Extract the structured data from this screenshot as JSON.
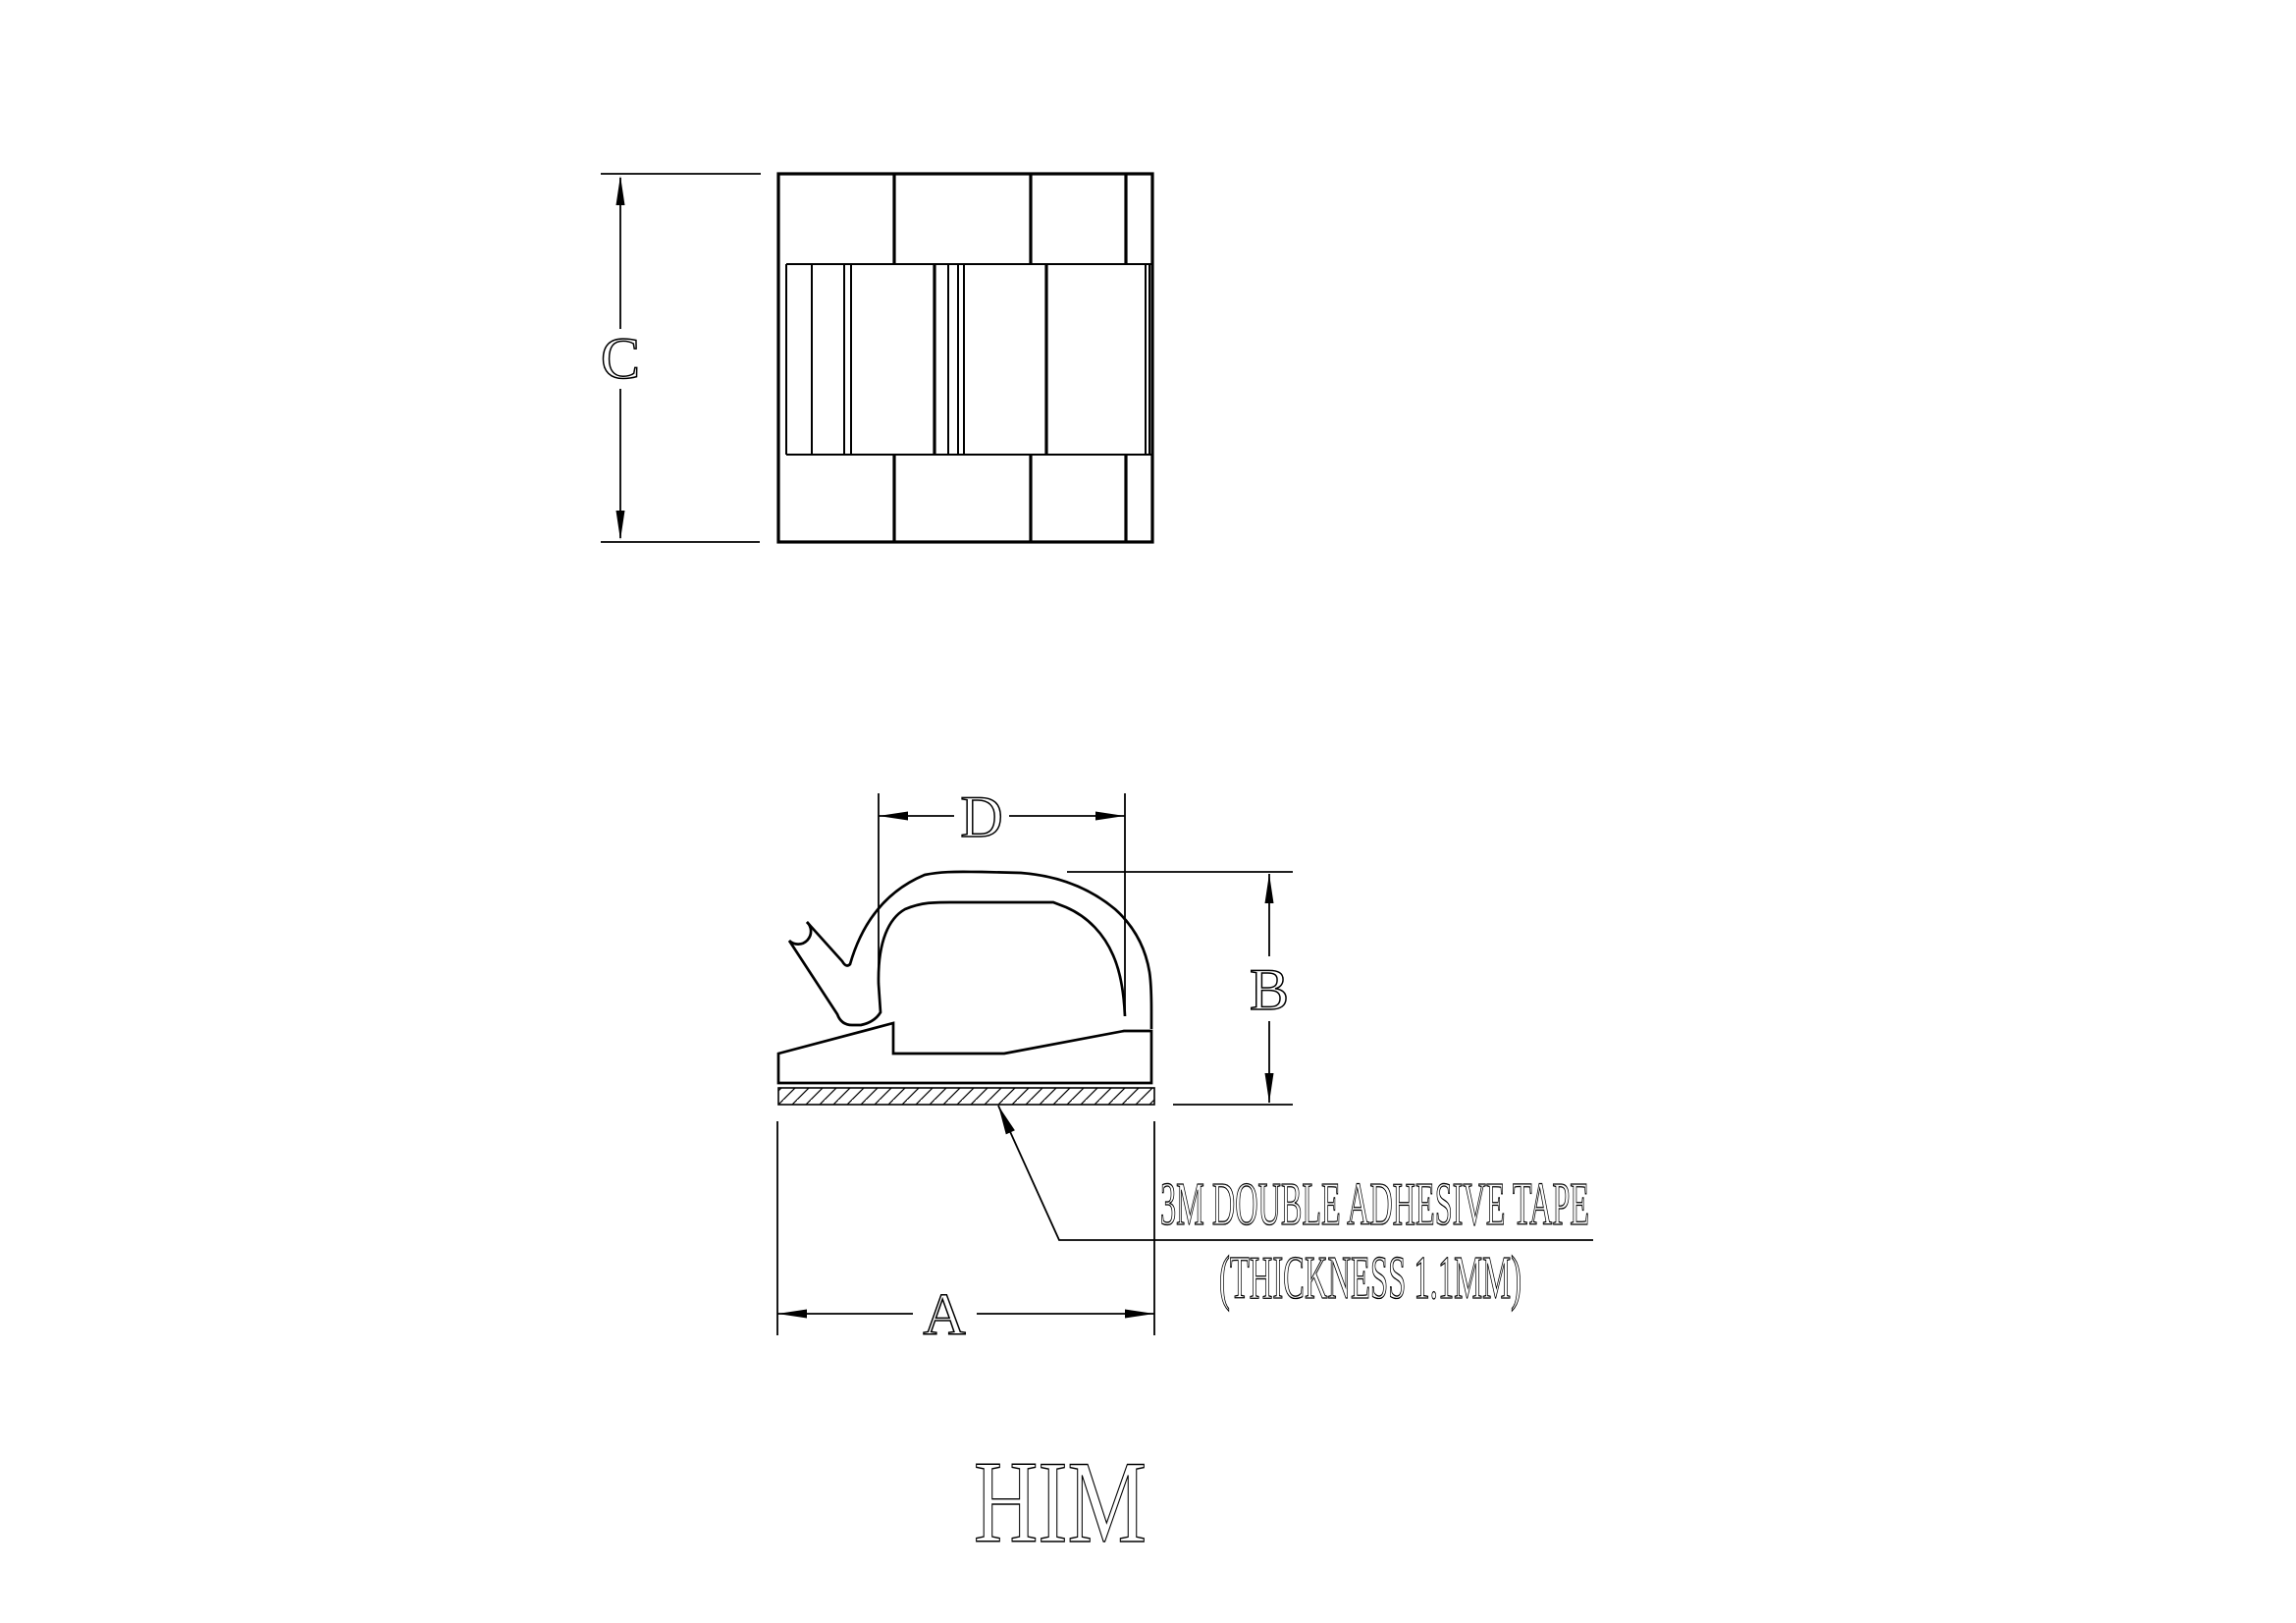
{
  "page": {
    "background_color": "#ffffff",
    "line_color": "#000000"
  },
  "dimensions": {
    "overall_height_top_view": "C",
    "loop_inner_width": "D",
    "clip_height": "B",
    "base_width": "A"
  },
  "note": {
    "line1": "3M DOUBLE ADHESIVE TAPE",
    "line2": "(THICKNESS 1.1MM)"
  },
  "logo": "HIM"
}
